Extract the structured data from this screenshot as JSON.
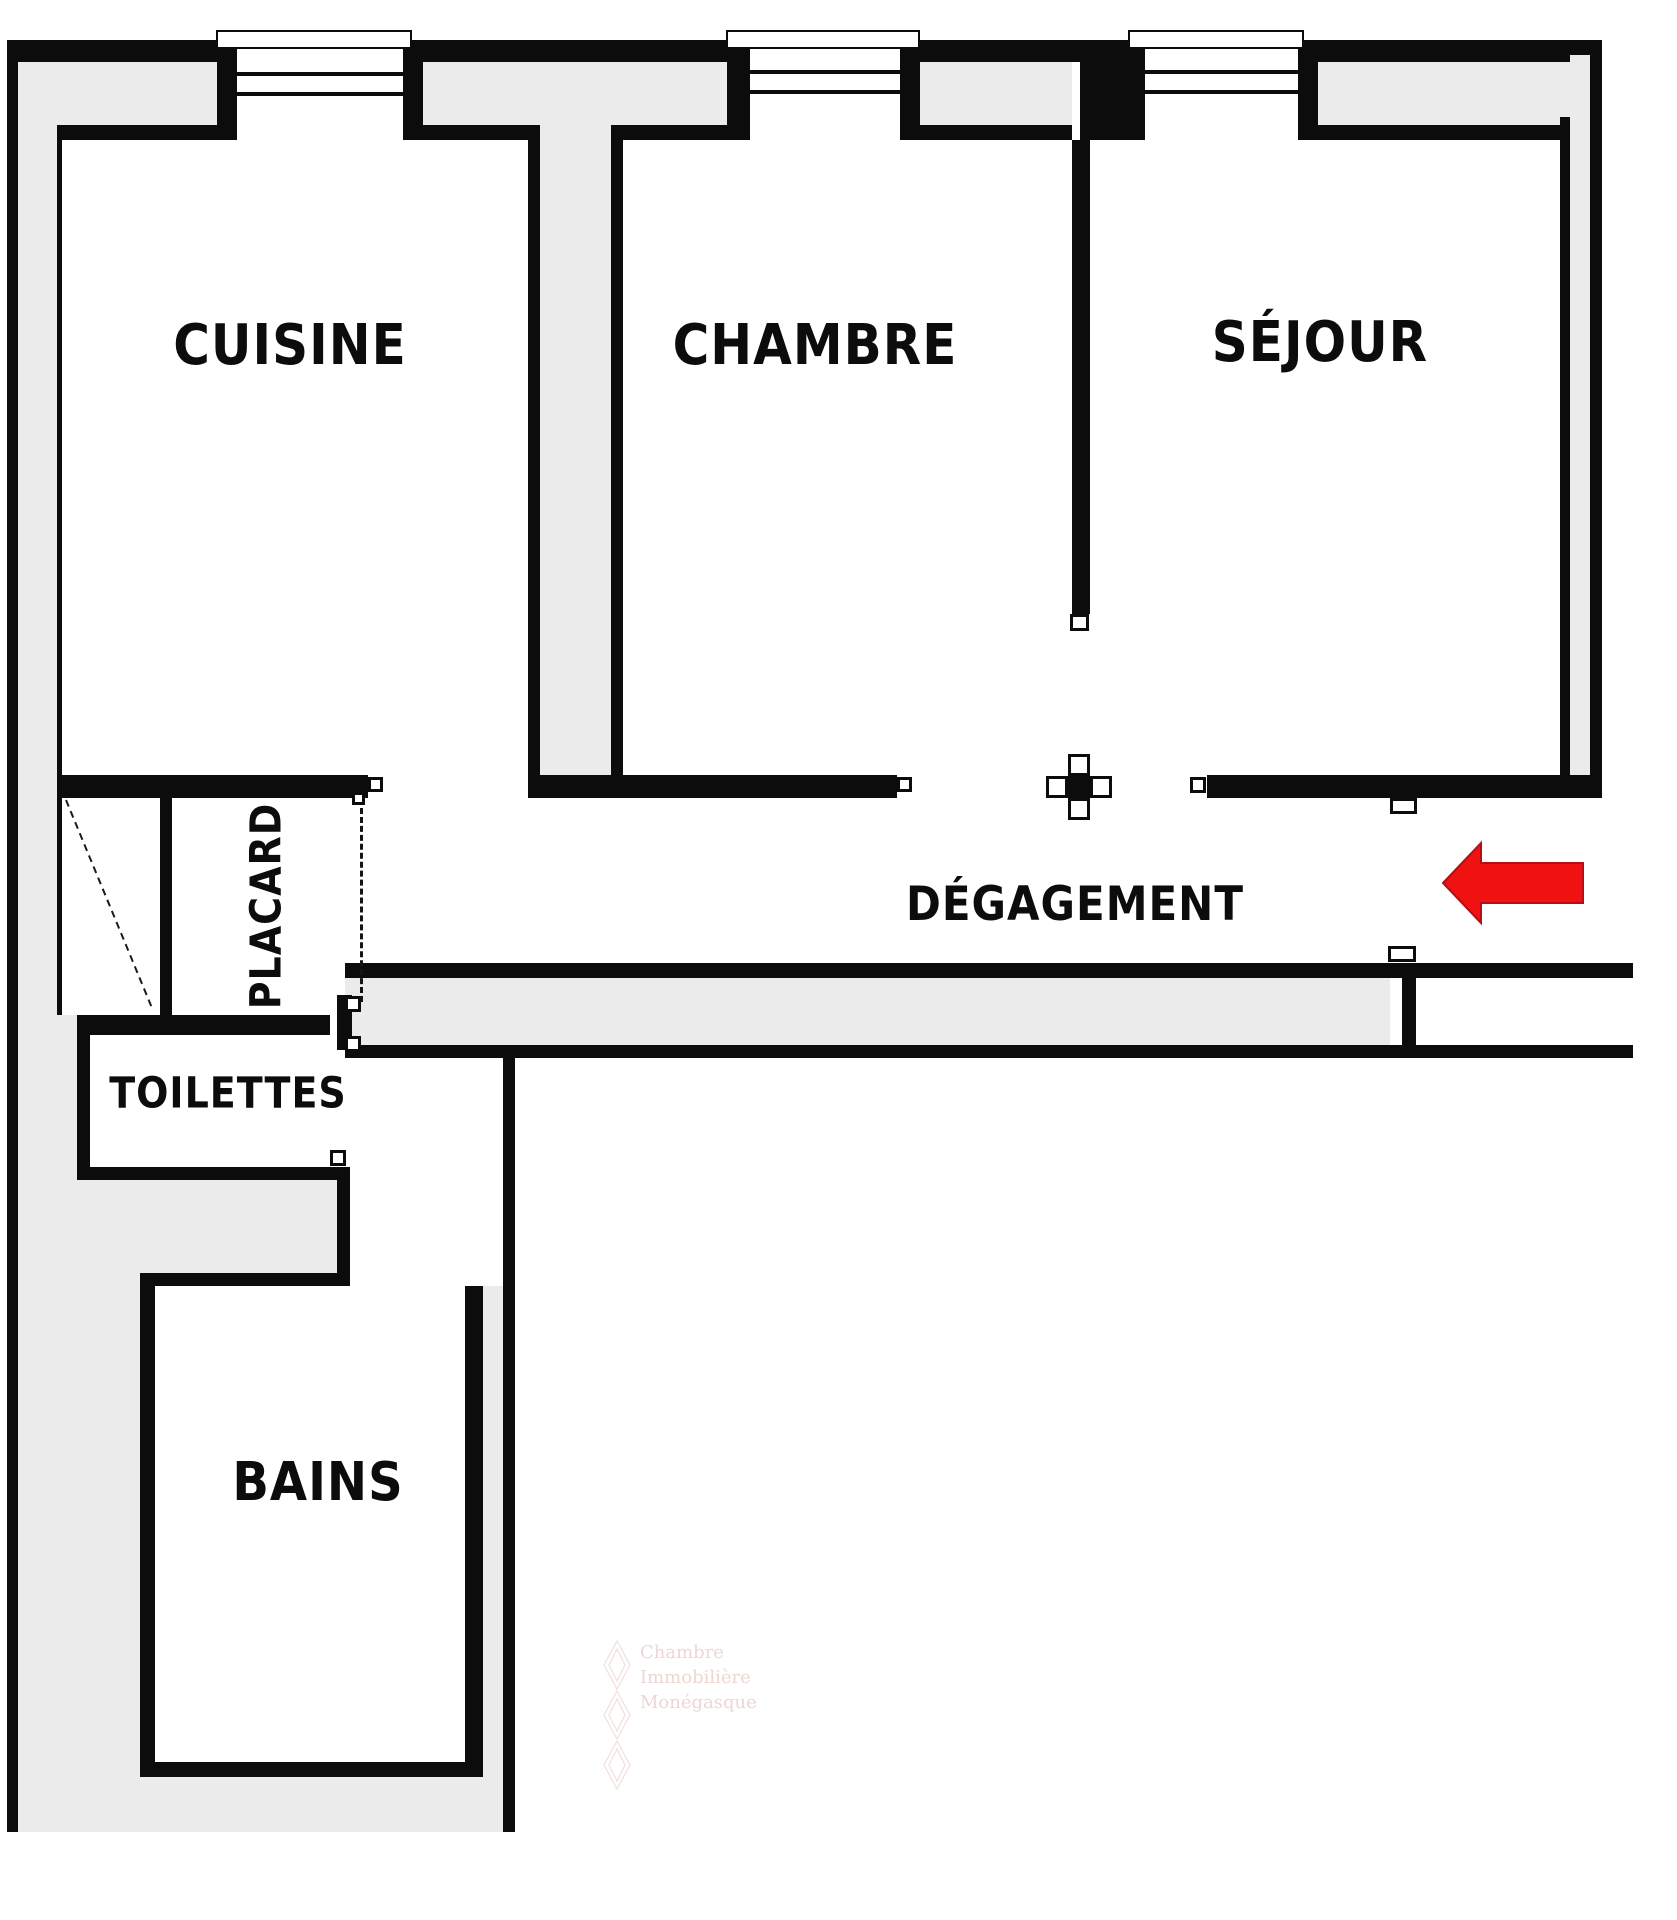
{
  "title": "Plan d'appartement",
  "colors": {
    "wall": "#0c0c0c",
    "poche": "#ebebeb",
    "bg": "#ffffff",
    "arrow_red": "#f01111",
    "watermark": "#eed6d3"
  },
  "rooms": {
    "cuisine": "CUISINE",
    "chambre": "CHAMBRE",
    "sejour": "SÉJOUR",
    "degagement": "DÉGAGEMENT",
    "placard": "PLACARD",
    "toilettes": "TOILETTES",
    "bains": "BAINS"
  },
  "watermark": {
    "line1": "Chambre",
    "line2": "Immobilière",
    "line3": "Monégasque"
  }
}
